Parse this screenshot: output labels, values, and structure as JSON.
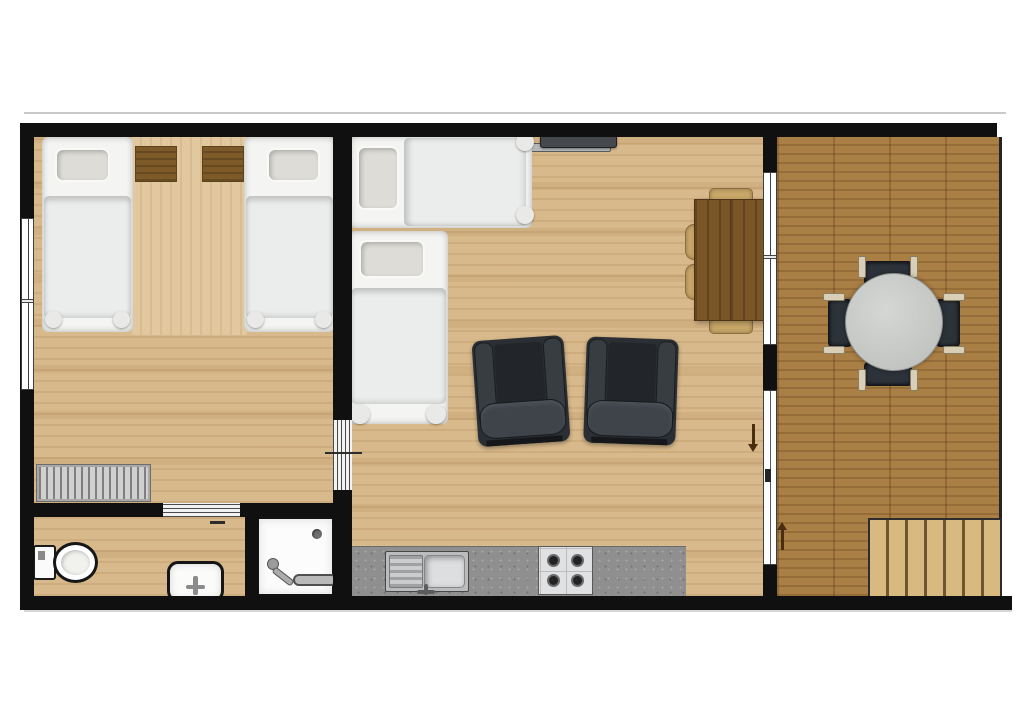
{
  "document": {
    "type": "architectural floor plan",
    "view": "top-down 2D render",
    "text_labels": "none — the plan contains no visible text",
    "background": "#ffffff"
  },
  "palette": {
    "walls": "#101010",
    "indoor_floor_oak": "#d8b98b",
    "bedroom_runner": "#e2c89e",
    "deck_floor": "#aa7f45",
    "kitchen_counter": "#8f8f8f",
    "white_fixtures": "#fcfcfc",
    "bedding_white": "#f4f4f2",
    "pillow_grey": "#dedcd6",
    "nightstand_wood": "#7d5a28",
    "dining_table_wood": "#7a5526",
    "dining_chair_wood": "#c8a768",
    "armchair_dark": "#2b2f33",
    "patio_chair_dark": "#2c323a",
    "patio_table_grey": "#c3c5c2",
    "stairs_tread": "#d8b97f",
    "radiator_grey": "#d0d0d0",
    "direction_arrow_brown": "#4a2e12"
  },
  "rooms": [
    {
      "name": "bedroom",
      "location": "top-left",
      "items": [
        {
          "item": "single-bed",
          "count": 2,
          "detail": "white duvet, grey pillow, footboard knobs"
        },
        {
          "item": "nightstand",
          "count": 2,
          "detail": "brown wood, between the beds on top wall"
        },
        {
          "item": "bedroom-runner",
          "count": 1,
          "detail": "lighter wood strip between beds"
        },
        {
          "item": "radiator",
          "count": 1,
          "detail": "grey finned, near bathroom wall"
        },
        {
          "item": "window",
          "count": 1,
          "detail": "left exterior wall, two panes"
        }
      ]
    },
    {
      "name": "bathroom",
      "location": "bottom-left",
      "items": [
        {
          "item": "toilet",
          "count": 1,
          "detail": "tank against left wall"
        },
        {
          "item": "washbasin",
          "count": 1,
          "detail": "against bottom wall, centered tap"
        },
        {
          "item": "shower-enclosure",
          "count": 1,
          "detail": "square tray, corner drain, hand shower and rail"
        }
      ]
    },
    {
      "name": "living-room-with-kitchenette",
      "location": "center",
      "items": [
        {
          "item": "single-bed",
          "count": 2,
          "detail": "L-arrangement in top-left corner, one horizontal one vertical"
        },
        {
          "item": "wall-tv",
          "count": 1,
          "detail": "mounted on top wall with bracket"
        },
        {
          "item": "armchair",
          "count": 2,
          "detail": "dark grey, slightly angled, facing tv"
        },
        {
          "item": "dining-table",
          "count": 1,
          "detail": "dark wood, against deck wall, chairs top/bottom and two tucked left"
        },
        {
          "item": "kitchen-counter",
          "count": 1,
          "detail": "grey speckled run along bottom wall"
        },
        {
          "item": "kitchen-sink",
          "count": 1,
          "detail": "stainless with left drainer"
        },
        {
          "item": "hob",
          "count": 1,
          "detail": "4 burners, 2x2"
        },
        {
          "item": "window",
          "count": 1,
          "detail": "to deck, upper section of shared wall"
        },
        {
          "item": "sliding-glass-door",
          "count": 1,
          "detail": "to deck, lower section of shared wall, with handle"
        }
      ]
    },
    {
      "name": "deck",
      "location": "right",
      "items": [
        {
          "item": "round-patio-table",
          "count": 1,
          "detail": "grey top"
        },
        {
          "item": "patio-chair",
          "count": 4,
          "detail": "dark seats, light wood armrests, N/S/E/W around table"
        },
        {
          "item": "staircase",
          "count": 1,
          "detail": "bottom-right corner, about 7 treads, descends off deck"
        }
      ]
    }
  ],
  "connections": [
    {
      "from": "bedroom",
      "to": "living-room",
      "via": "louvre-marked doorway in dividing wall"
    },
    {
      "from": "bedroom",
      "to": "bathroom",
      "via": "louvre-marked doorway in bathroom wall"
    },
    {
      "from": "living-room",
      "to": "deck",
      "via": "sliding glass door"
    }
  ],
  "annotations": [
    {
      "type": "direction-arrow",
      "color": "#4a2e12",
      "location": "living-room side of sliding door",
      "direction": "down"
    },
    {
      "type": "direction-arrow",
      "color": "#4a2e12",
      "location": "deck side of sliding door",
      "direction": "up"
    },
    {
      "type": "tick-mark",
      "location": "crossing bedroom doorway"
    },
    {
      "type": "dash-mark",
      "location": "bathroom near doorway"
    }
  ]
}
